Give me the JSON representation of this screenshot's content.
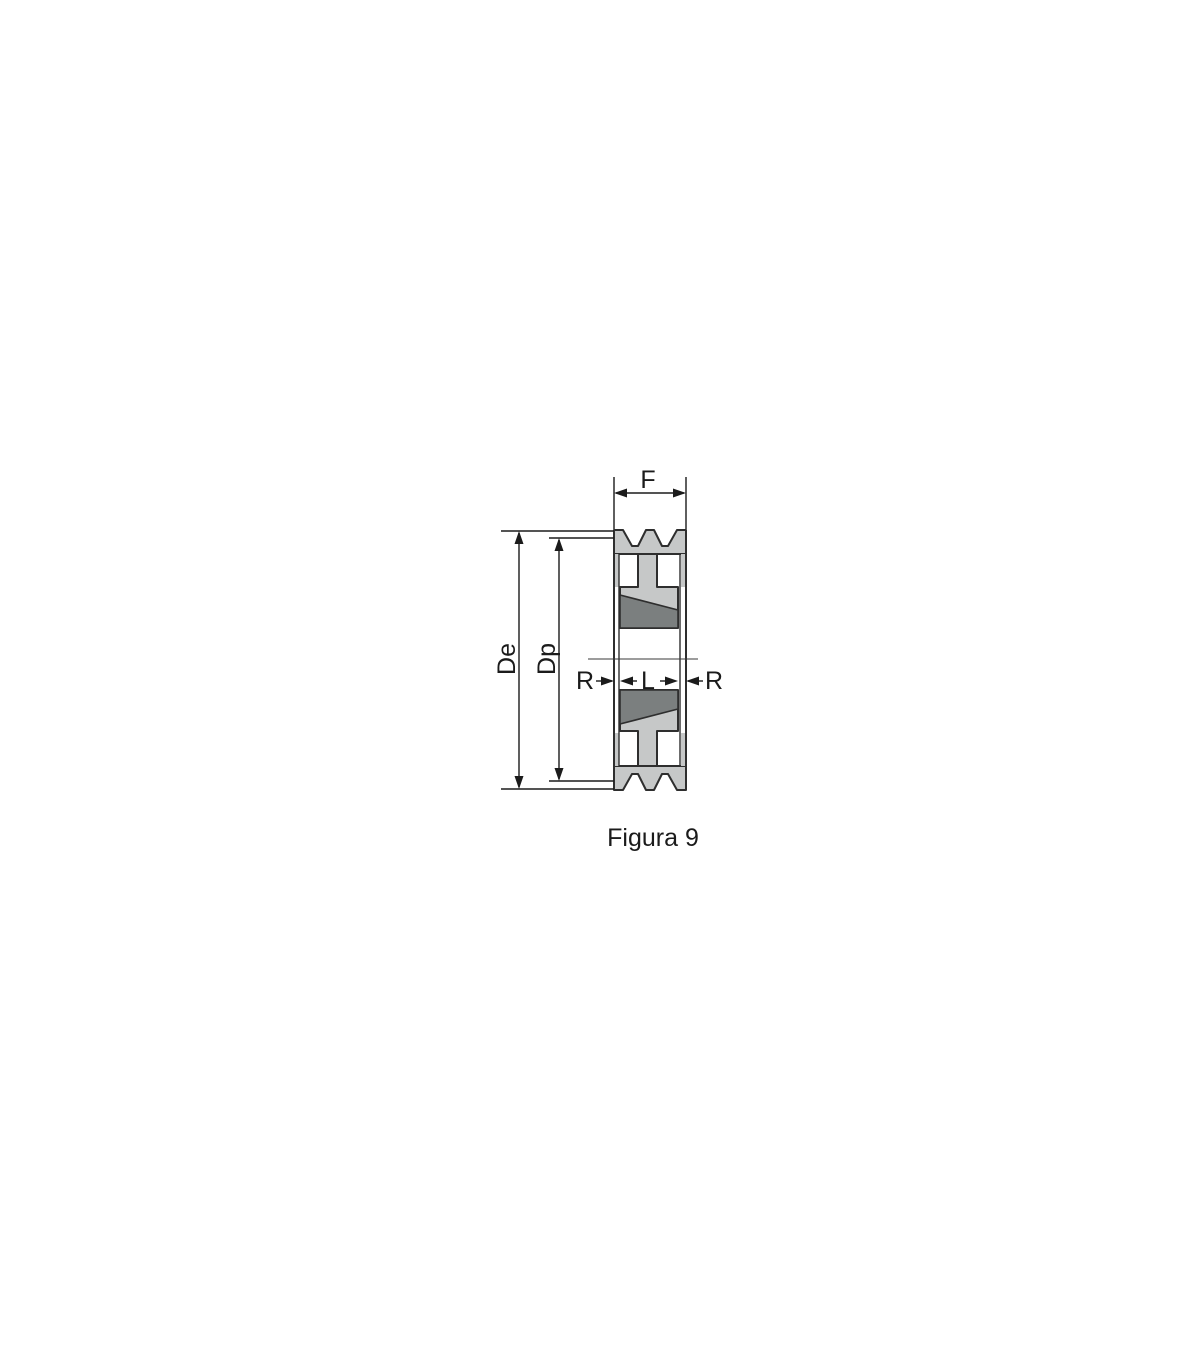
{
  "figure": {
    "caption": "Figura 9",
    "labels": {
      "face_width": "F",
      "outer_diameter": "De",
      "pitch_diameter": "Dp",
      "recess_left": "R",
      "bush_length": "L",
      "recess_right": "R"
    },
    "colors": {
      "background": "#ffffff",
      "body_fill": "#c6c8c8",
      "bush_fill": "#7b7f7f",
      "outline": "#2e2e2e",
      "dimension_line": "#1b1b1b",
      "center_line": "#3a3a3a",
      "text": "#1b1b1b"
    }
  }
}
